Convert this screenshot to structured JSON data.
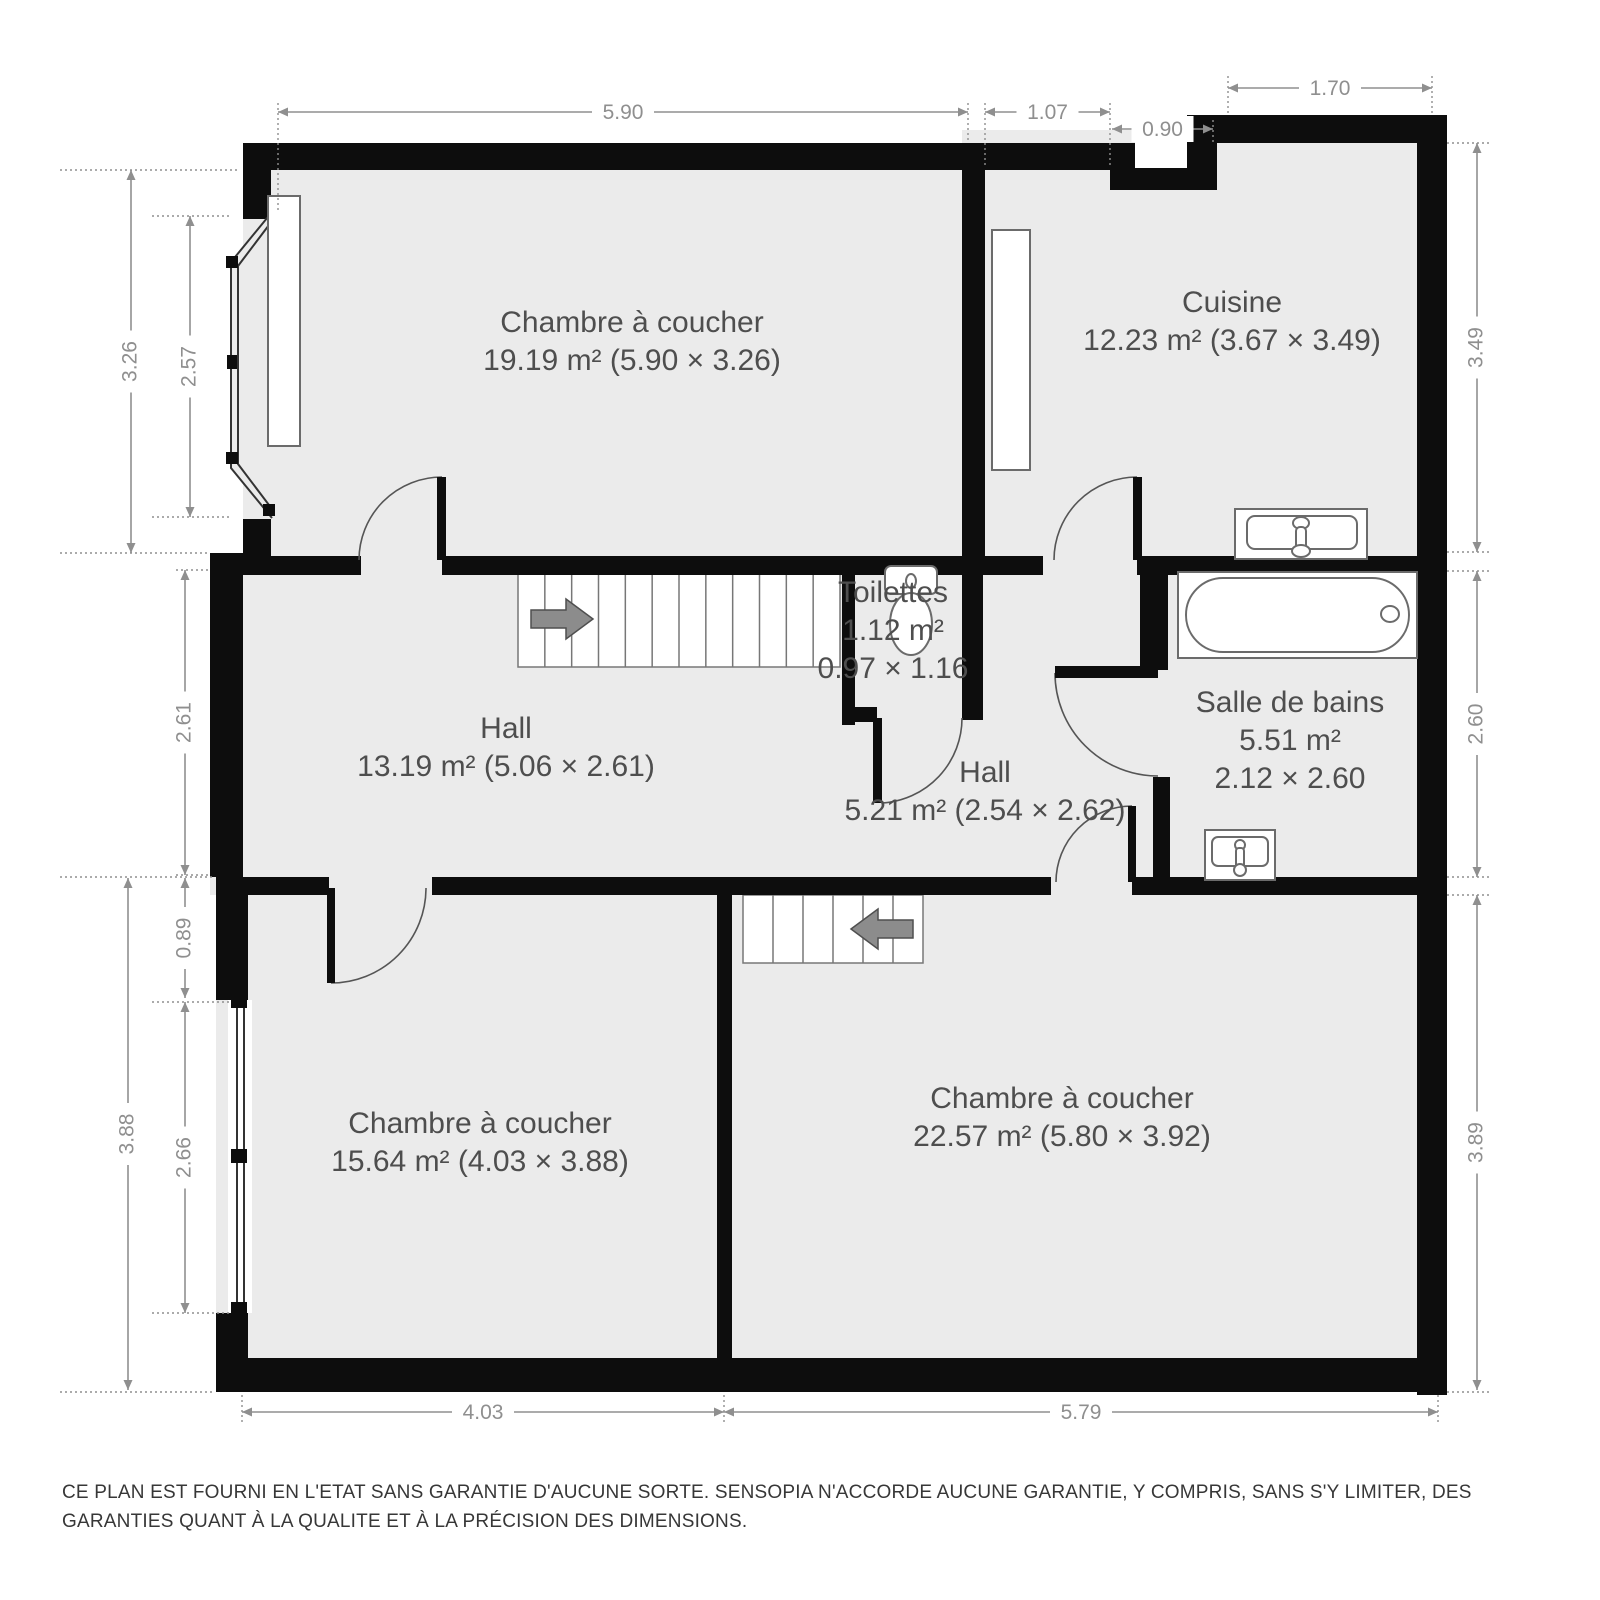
{
  "disclaimer": "CE PLAN EST FOURNI EN L'ETAT SANS GARANTIE D'AUCUNE SORTE. SENSOPIA N'ACCORDE AUCUNE GARANTIE, Y COMPRIS, SANS S'Y LIMITER, DES GARANTIES QUANT À LA QUALITE ET À LA PRÉCISION DES DIMENSIONS.",
  "colors": {
    "background": "#ffffff",
    "floor": "#ebebeb",
    "wall": "#0d0d0d",
    "room_label": "#4e4e4e",
    "dimension": "#8f8f8f",
    "fixture_stroke": "#6b6b6b",
    "door": "#555555",
    "stairs_stroke": "#777777",
    "arrow_fill": "#8c8c8c"
  },
  "rooms": [
    {
      "id": "bedroom-top",
      "cx": 632,
      "cy": 332,
      "lines": [
        "Chambre à coucher",
        "19.19 m² (5.90 × 3.26)"
      ]
    },
    {
      "id": "cuisine",
      "cx": 1232,
      "cy": 312,
      "lines": [
        "Cuisine",
        "12.23 m² (3.67 × 3.49)"
      ]
    },
    {
      "id": "toilettes",
      "cx": 893,
      "cy": 602,
      "lines": [
        "Toilettes",
        "1.12 m²",
        "0.97 × 1.16"
      ]
    },
    {
      "id": "hall-main",
      "cx": 506,
      "cy": 738,
      "lines": [
        "Hall",
        "13.19 m² (5.06 × 2.61)"
      ]
    },
    {
      "id": "hall-small",
      "cx": 985,
      "cy": 782,
      "lines": [
        "Hall",
        "5.21 m² (2.54 × 2.62)"
      ]
    },
    {
      "id": "salle-de-bains",
      "cx": 1290,
      "cy": 712,
      "lines": [
        "Salle de bains",
        "5.51 m²",
        "2.12 × 2.60"
      ]
    },
    {
      "id": "bedroom-bottom-left",
      "cx": 480,
      "cy": 1133,
      "lines": [
        "Chambre à coucher",
        "15.64 m² (4.03 × 3.88)"
      ]
    },
    {
      "id": "bedroom-bottom-right",
      "cx": 1062,
      "cy": 1108,
      "lines": [
        "Chambre à coucher",
        "22.57 m² (5.80 × 3.92)"
      ]
    }
  ],
  "plan": {
    "floors": [
      [
        243,
        160,
        742,
        415
      ],
      [
        962,
        130,
        485,
        445
      ],
      [
        210,
        556,
        960,
        339
      ],
      [
        1135,
        556,
        312,
        339
      ],
      [
        216,
        877,
        516,
        515
      ],
      [
        717,
        877,
        730,
        515
      ]
    ],
    "bay_floor": "272,212 231,262 231,468 272,518",
    "masks": [
      [
        1135,
        138,
        52,
        31
      ],
      [
        228,
        1000,
        24,
        313
      ]
    ],
    "walls": [
      [
        243,
        143,
        892,
        27
      ],
      [
        1110,
        168,
        107,
        22
      ],
      [
        1187,
        115,
        30,
        75
      ],
      [
        1217,
        115,
        230,
        28
      ],
      [
        1417,
        115,
        30,
        1280
      ],
      [
        216,
        1358,
        1231,
        34
      ],
      [
        243,
        143,
        28,
        76
      ],
      [
        243,
        519,
        28,
        56
      ],
      [
        210,
        553,
        33,
        324
      ],
      [
        216,
        877,
        32,
        123
      ],
      [
        216,
        1313,
        32,
        79
      ],
      [
        210,
        556,
        151,
        19
      ],
      [
        442,
        556,
        601,
        19
      ],
      [
        1137,
        556,
        310,
        19
      ],
      [
        962,
        143,
        23,
        432
      ],
      [
        842,
        575,
        13,
        150
      ],
      [
        842,
        707,
        35,
        15
      ],
      [
        962,
        575,
        21,
        145
      ],
      [
        1140,
        556,
        28,
        114
      ],
      [
        1153,
        777,
        17,
        103
      ],
      [
        216,
        877,
        113,
        18
      ],
      [
        432,
        877,
        619,
        18
      ],
      [
        1132,
        877,
        315,
        18
      ],
      [
        717,
        877,
        15,
        515
      ]
    ],
    "stairs": [
      {
        "x": 518,
        "y": 572,
        "w": 322,
        "h": 95,
        "treads": 12,
        "arrow": {
          "dir": "right",
          "tip": [
            593,
            619
          ]
        }
      },
      {
        "x": 743,
        "y": 895,
        "w": 180,
        "h": 68,
        "treads": 6,
        "arrow": {
          "dir": "left",
          "tip": [
            851,
            929
          ]
        }
      }
    ],
    "doors": [
      {
        "name": "bedroom-top-door",
        "leaf": [
          437,
          477,
          9,
          83
        ],
        "arc": "M 442 477 A 83 83 0 0 0 359 560"
      },
      {
        "name": "cuisine-door",
        "leaf": [
          1133,
          477,
          9,
          83
        ],
        "arc": "M 1137 477 A 83 83 0 0 0 1054 560"
      },
      {
        "name": "toilettes-door",
        "leaf": [
          873,
          718,
          9,
          85
        ],
        "arc": "M 882 803 A 85 85 0 0 0 962 718"
      },
      {
        "name": "bathroom-door",
        "leaf": [
          1055,
          666,
          103,
          12
        ],
        "arc": "M 1055 673 A 103 103 0 0 0 1158 776"
      },
      {
        "name": "bedroom-bottom-right-door",
        "leaf": [
          1128,
          806,
          8,
          76
        ],
        "arc": "M 1132 806 A 76 76 0 0 0 1056 882"
      },
      {
        "name": "bedroom-bottom-left-door",
        "leaf": [
          327,
          888,
          8,
          95
        ],
        "arc": "M 426 888 A 95 95 0 0 1 331 983"
      }
    ],
    "window_lines": [
      "272,212 231,262 231,468 272,518",
      "272,221 238,266 238,464 272,509",
      "237,1002 237,1313",
      "244,1002 244,1313"
    ],
    "window_blocks": [
      [
        263,
        204,
        12,
        12
      ],
      [
        226,
        256,
        12,
        12
      ],
      [
        227,
        355,
        10,
        14
      ],
      [
        226,
        452,
        12,
        12
      ],
      [
        263,
        504,
        12,
        12
      ],
      [
        231,
        996,
        16,
        12
      ],
      [
        231,
        1149,
        16,
        14
      ],
      [
        231,
        1302,
        16,
        12
      ]
    ],
    "fixtures": [
      {
        "name": "window-sill",
        "t": "rect",
        "a": [
          268,
          196,
          32,
          250
        ]
      },
      {
        "name": "kitchen-counter",
        "t": "rect",
        "a": [
          992,
          230,
          38,
          240
        ]
      },
      {
        "name": "toilet-tank",
        "t": "rrect",
        "a": [
          885,
          566,
          52,
          28,
          6
        ]
      },
      {
        "name": "toilet-button",
        "t": "ellipse",
        "a": [
          911,
          581,
          5,
          7
        ]
      },
      {
        "name": "toilet-bowl",
        "t": "ellipse",
        "a": [
          911,
          624,
          21,
          31
        ]
      },
      {
        "name": "kitchen-sink-outer",
        "t": "rect",
        "a": [
          1235,
          509,
          132,
          50
        ]
      },
      {
        "name": "kitchen-sink-basin",
        "t": "rrect",
        "a": [
          1247,
          516,
          110,
          33,
          8
        ]
      },
      {
        "name": "kitchen-sink-faucet-top",
        "t": "ellipse",
        "a": [
          1301,
          523,
          8,
          6
        ]
      },
      {
        "name": "kitchen-sink-faucet-stem",
        "t": "rrect",
        "a": [
          1296,
          527,
          10,
          22,
          4
        ]
      },
      {
        "name": "kitchen-sink-faucet-base",
        "t": "ellipse",
        "a": [
          1301,
          551,
          9,
          6
        ]
      },
      {
        "name": "bathtub-outer",
        "t": "rect",
        "a": [
          1178,
          572,
          239,
          86
        ]
      },
      {
        "name": "bathtub-inner",
        "t": "rrect",
        "a": [
          1186,
          578,
          223,
          74,
          37
        ]
      },
      {
        "name": "bathtub-drain",
        "t": "ellipse",
        "a": [
          1390,
          614,
          9,
          8
        ]
      },
      {
        "name": "bathroom-sink-outer",
        "t": "rect",
        "a": [
          1205,
          830,
          70,
          50
        ]
      },
      {
        "name": "bathroom-sink-basin",
        "t": "rrect",
        "a": [
          1212,
          837,
          56,
          29,
          6
        ]
      },
      {
        "name": "bathroom-sink-faucet-top",
        "t": "ellipse",
        "a": [
          1240,
          845,
          5,
          5
        ]
      },
      {
        "name": "bathroom-sink-faucet-stem",
        "t": "rrect",
        "a": [
          1236,
          848,
          8,
          20,
          3
        ]
      },
      {
        "name": "bathroom-sink-faucet-base",
        "t": "ellipse",
        "a": [
          1240,
          870,
          6,
          6
        ]
      }
    ],
    "dimensions_horizontal": [
      {
        "y": 112,
        "x1": 278,
        "x2": 968,
        "t": "5.90"
      },
      {
        "y": 112,
        "x1": 985,
        "x2": 1110,
        "t": "1.07"
      },
      {
        "y": 129,
        "x1": 1112,
        "x2": 1213,
        "t": "0.90"
      },
      {
        "y": 88,
        "x1": 1228,
        "x2": 1432,
        "t": "1.70"
      },
      {
        "y": 1412,
        "x1": 242,
        "x2": 724,
        "t": "4.03"
      },
      {
        "y": 1412,
        "x1": 724,
        "x2": 1438,
        "t": "5.79"
      }
    ],
    "dimensions_vertical": [
      {
        "x": 131,
        "y1": 170,
        "y2": 553,
        "t": "3.26"
      },
      {
        "x": 190,
        "y1": 216,
        "y2": 517,
        "t": "2.57"
      },
      {
        "x": 185,
        "y1": 570,
        "y2": 875,
        "t": "2.61"
      },
      {
        "x": 185,
        "y1": 878,
        "y2": 998,
        "t": "0.89"
      },
      {
        "x": 128,
        "y1": 878,
        "y2": 1390,
        "t": "3.88"
      },
      {
        "x": 185,
        "y1": 1002,
        "y2": 1313,
        "t": "2.66"
      },
      {
        "x": 1477,
        "y1": 143,
        "y2": 552,
        "t": "3.49"
      },
      {
        "x": 1477,
        "y1": 571,
        "y2": 877,
        "t": "2.60"
      },
      {
        "x": 1477,
        "y1": 895,
        "y2": 1390,
        "t": "3.89"
      }
    ],
    "leaders": [
      [
        60,
        170,
        240,
        170
      ],
      [
        60,
        553,
        208,
        553
      ],
      [
        152,
        216,
        229,
        216
      ],
      [
        152,
        517,
        229,
        517
      ],
      [
        60,
        877,
        214,
        877
      ],
      [
        60,
        1392,
        214,
        1392
      ],
      [
        152,
        1002,
        232,
        1002
      ],
      [
        152,
        1313,
        232,
        1313
      ],
      [
        278,
        103,
        278,
        212
      ],
      [
        968,
        103,
        968,
        143
      ],
      [
        985,
        103,
        985,
        168
      ],
      [
        1110,
        103,
        1110,
        168
      ],
      [
        1213,
        120,
        1213,
        143
      ],
      [
        1228,
        76,
        1228,
        115
      ],
      [
        1432,
        76,
        1432,
        115
      ],
      [
        1447,
        143,
        1492,
        143
      ],
      [
        1447,
        552,
        1492,
        552
      ],
      [
        1447,
        571,
        1492,
        571
      ],
      [
        1447,
        877,
        1492,
        877
      ],
      [
        1447,
        895,
        1492,
        895
      ],
      [
        1447,
        1392,
        1492,
        1392
      ],
      [
        242,
        1395,
        242,
        1422
      ],
      [
        724,
        1395,
        724,
        1422
      ],
      [
        1438,
        1395,
        1438,
        1422
      ],
      [
        176,
        570,
        210,
        570
      ],
      [
        176,
        875,
        210,
        875
      ]
    ]
  }
}
